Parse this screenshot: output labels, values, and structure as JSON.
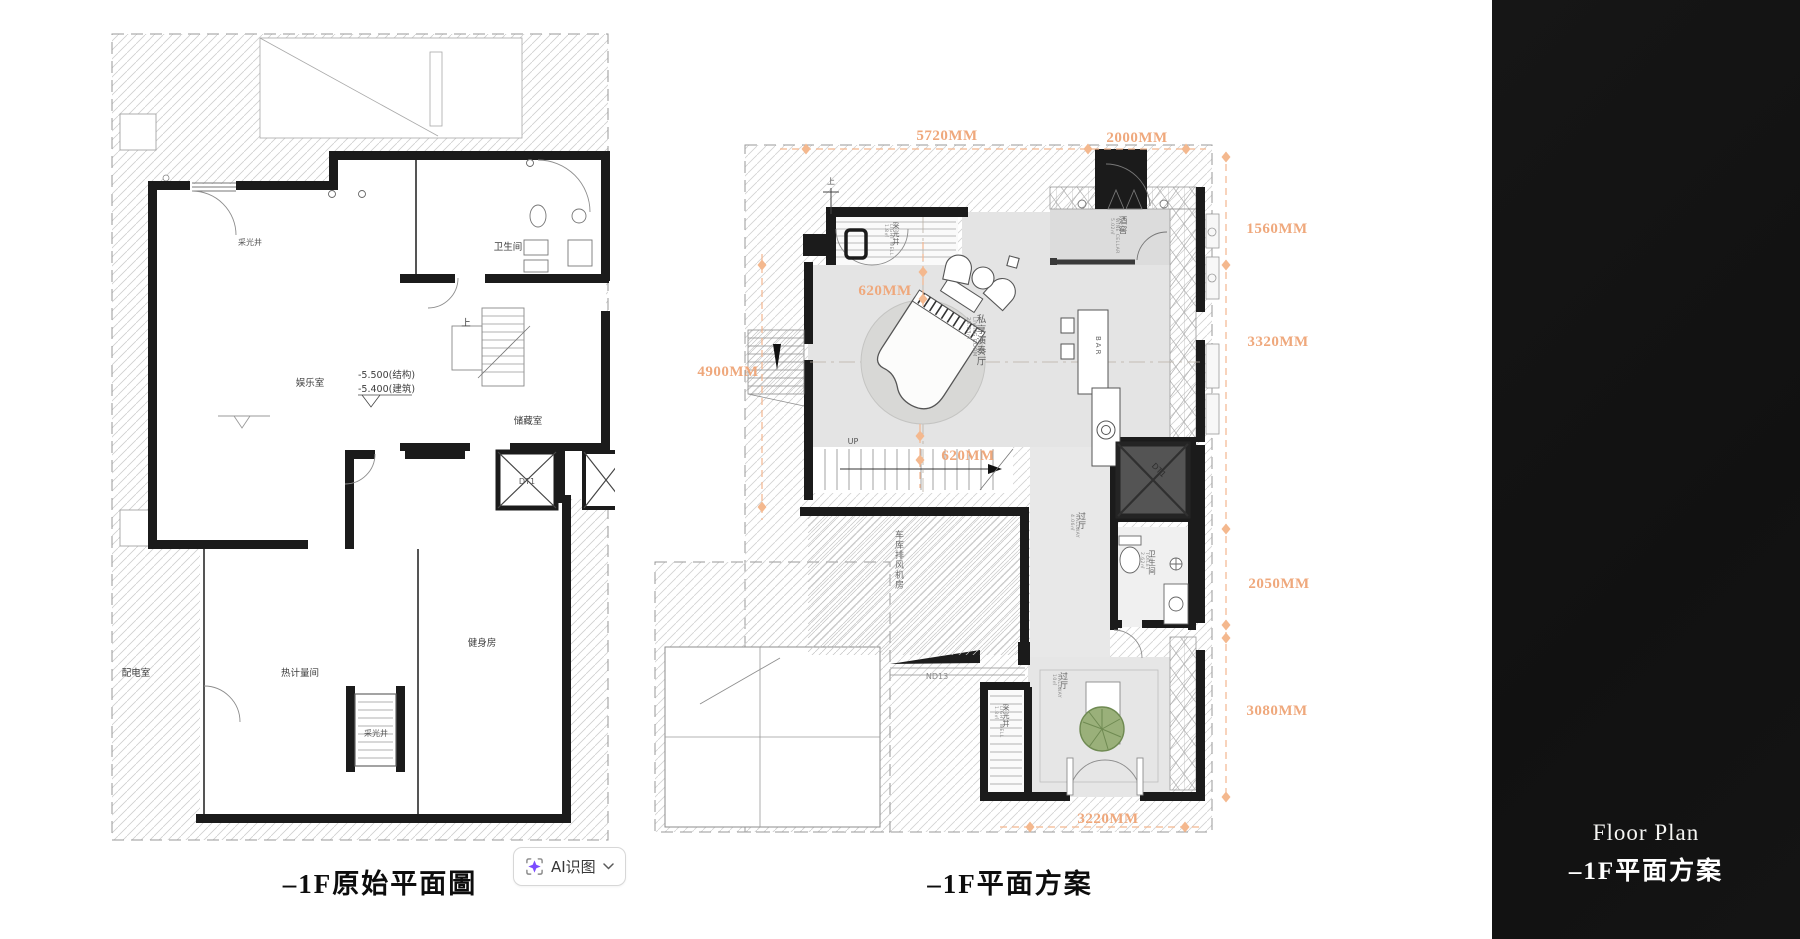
{
  "titles": {
    "left_plan": "–1F原始平面圖",
    "middle_plan": "–1F平面方案"
  },
  "ai_button": {
    "label": "AI识图"
  },
  "right_panel": {
    "title_en": "Floor Plan",
    "title_zh": "–1F平面方案"
  },
  "left_plan": {
    "rooms": {
      "light_well_top": "采光井",
      "entertainment": "娱乐室",
      "elev_structural": "-5.500(结构)",
      "elev_architectural": "-5.400(建筑)",
      "bathroom": "卫生间",
      "up": "上",
      "storage": "储藏室",
      "elevator": "DT1",
      "gym": "健身房",
      "heat_meter": "热计量间",
      "power_room": "配电室",
      "light_well_bottom": "采光井"
    }
  },
  "middle_plan": {
    "rooms": {
      "light_well_top_zh": "采光井",
      "light_well_top_en": "LIGHT WELL",
      "light_well_top_area": "1.8㎡",
      "wine_cellar_zh": "酒窖",
      "wine_cellar_en": "WINE CELLAR",
      "wine_cellar_area": "5.02㎡",
      "living_zh": "私享演奏厅",
      "living_en": "LIVING ROOM",
      "living_area": "28.03㎡",
      "bar": "BAR",
      "up": "UP",
      "up_sign": "上",
      "garage_fan": "车库排风机房",
      "elevator": "DT1",
      "hallway1_zh": "过厅",
      "hallway1_en": "HALLWAY",
      "hallway1_area": "4.06㎡",
      "toilet_zh": "卫生间",
      "toilet_en": "TOILET",
      "toilet_area": "2.62㎡",
      "hallway2_zh": "过厅",
      "hallway2_en": "HALLWAY",
      "hallway2_area": "10㎡",
      "light_well_bottom_zh": "采光井",
      "light_well_bottom_en": "LIGHT WELL",
      "light_well_bottom_area": "1.8㎡",
      "nd13": "ND13"
    },
    "dimensions": {
      "d5720": "5720MM",
      "d2000": "2000MM",
      "d1560": "1560MM",
      "d3320": "3320MM",
      "d2050": "2050MM",
      "d3080": "3080MM",
      "d4900": "4900MM",
      "d620a": "620MM",
      "d620b": "620MM",
      "d3220": "3220MM"
    }
  },
  "colors": {
    "dimension_text": "#efa87c",
    "dimension_diamond": "#f4b88e",
    "wall": "#1c1c1c",
    "floor_gray": "#e4e4e4",
    "panel_bg": "#131313",
    "button_icon_purple": "#7c4dff",
    "plant_green": "#95ad77"
  }
}
